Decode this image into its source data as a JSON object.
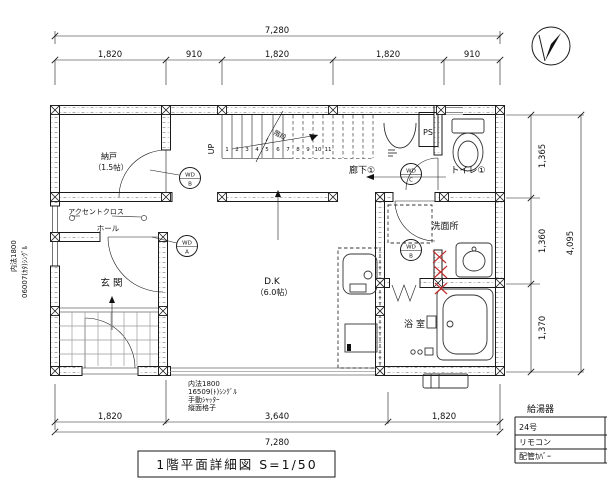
{
  "title_block": {
    "label": "1階平面詳細図  S=1/50"
  },
  "dims": {
    "top_total": "7,280",
    "top": [
      "1,820",
      "910",
      "1,820",
      "1,820",
      "910"
    ],
    "bottom": [
      "1,820",
      "3,640",
      "1,820"
    ],
    "bottom_total": "7,280",
    "right": [
      "1,365",
      "1,360",
      "1,370"
    ],
    "right_total": "4,095"
  },
  "rooms": {
    "storage": "納戸",
    "storage_size": "（1.5帖）",
    "hall": "ホール",
    "entrance": "玄関",
    "corridor": "廊下①",
    "toilet": "トイレ①",
    "ps": "PS",
    "washroom": "洗面所",
    "bathroom": "浴室",
    "dk": "D.K",
    "dk_size": "（6.0帖）",
    "stairs": "階段",
    "up": "UP"
  },
  "stair_numbers": [
    "1",
    "2",
    "3",
    "4",
    "5",
    "6",
    "7",
    "8",
    "9",
    "10",
    "11"
  ],
  "door_tags": {
    "storage_top": "WD",
    "storage_bottom": "B",
    "hall_top": "WD",
    "hall_bottom": "A",
    "toilet_top": "WD",
    "toilet_bottom": "C",
    "washroom_top": "WD",
    "washroom_bottom": "B"
  },
  "annotations": {
    "left_line1": "内法1800",
    "left_line2": "06007(ｶﾀ)ｼﾝｸﾞﾙ",
    "accent": "アクセントクロス",
    "win_line1": "内法1800",
    "win_line2": "16509(ﾄ)ｼﾝｸﾞﾙ",
    "win_line3": "手動ｼｬｯﾀｰ",
    "win_line4": "縦面格子"
  },
  "equipment": {
    "header": "給湯器",
    "rows": [
      "24号",
      "リモコン",
      "配管ｶﾊﾞｰ"
    ]
  },
  "colors": {
    "line": "#1a1a1a",
    "red": "#c23030",
    "bg": "#ffffff"
  }
}
